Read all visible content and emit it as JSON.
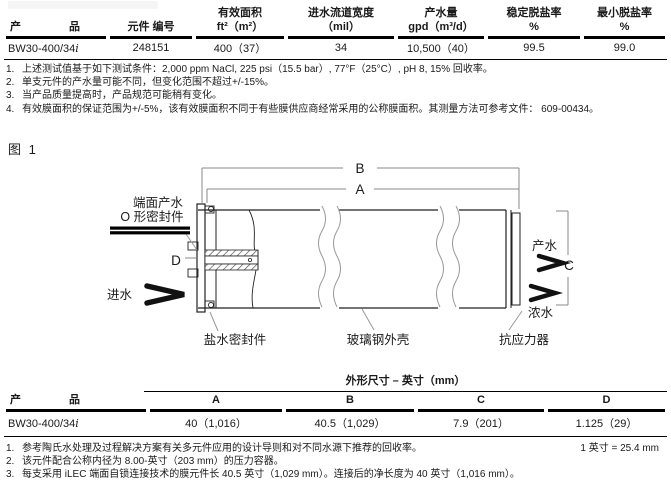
{
  "page": {
    "figure_label": "图 1"
  },
  "table1": {
    "headers": {
      "product_l": "产",
      "product_r": "品",
      "part_no": "元件 编号",
      "area_1": "有效面积",
      "area_2": "ft²（m²）",
      "channel_1": "进水流道宽度",
      "channel_2": "（mil）",
      "flow_1": "产水量",
      "flow_2": "gpd（m³/d）",
      "rej_1": "稳定脱盐率",
      "rej_2": "%",
      "minrej_1": "最小脱盐率",
      "minrej_2": "%"
    },
    "row": {
      "product": "BW30-400/34",
      "product_suffix": "i",
      "part_no": "248151",
      "area": "400（37）",
      "channel": "34",
      "flow": "10,500（40）",
      "rejection": "99.5",
      "min_rejection": "99.0"
    }
  },
  "footnotes_top": {
    "items": [
      {
        "num": "1.",
        "text": "上述测试值基于如下测试条件：2,000 ppm NaCl, 225 psi（15.5 bar）, 77°F（25°C）, pH 8, 15% 回收率。"
      },
      {
        "num": "2.",
        "text": "单支元件的产水量可能不同，但变化范围不超过+/-15%。"
      },
      {
        "num": "3.",
        "text": "当产品质量提高时，产品规范可能稍有变化。"
      },
      {
        "num": "4.",
        "text": "有效膜面积的保证范围为+/-5%，该有效膜面积不同于有些膜供应商经常采用的公称膜面积。其测量方法可参考文件： 609-00434。"
      }
    ]
  },
  "diagram": {
    "labels": {
      "end_seal_1": "端面产水",
      "end_seal_2": "O 形密封件",
      "dim_a": "A",
      "dim_b": "B",
      "dim_c": "C",
      "dim_d": "D",
      "feed": "进水",
      "permeate": "产水",
      "concentrate": "浓水",
      "brine_seal": "盐水密封件",
      "fiberglass_shell": "玻璃钢外壳",
      "anti_telescoping": "抗应力器"
    }
  },
  "table2": {
    "span_header": "外形尺寸 – 英寸（mm）",
    "headers": {
      "product_l": "产",
      "product_r": "品",
      "a": "A",
      "b": "B",
      "c": "C",
      "d": "D"
    },
    "row": {
      "product": "BW30-400/34",
      "product_suffix": "i",
      "a": "40（1,016）",
      "b": "40.5（1,029）",
      "c": "7.9（201）",
      "d": "1.125（29）"
    }
  },
  "footnotes_bottom": {
    "items": [
      {
        "num": "1.",
        "text": "参考陶氏水处理及过程解决方案有关多元件应用的设计导则和对不同水源下推荐的回收率。"
      },
      {
        "num": "2.",
        "text": "该元件配合公称内径为 8.00-英寸（203 mm）的压力容器。"
      },
      {
        "num": "3.",
        "text": "每支采用 iLEC 端面自锁连接技术的膜元件长 40.5 英寸（1,029 mm）。连接后的净长度为 40 英寸（1,016 mm）。"
      }
    ],
    "conversion": "1 英寸 = 25.4 mm"
  },
  "colors": {
    "ink": "#1a1a1a",
    "rule": "#000000",
    "leader": "#999999"
  }
}
